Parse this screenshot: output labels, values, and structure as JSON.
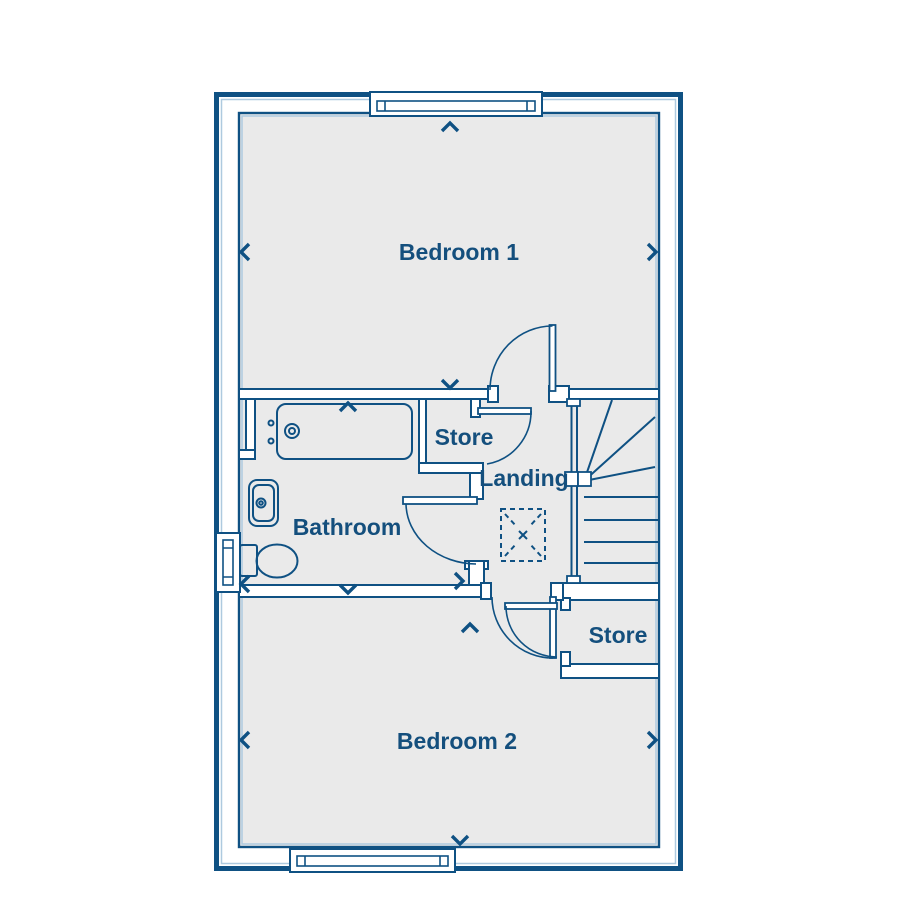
{
  "plan": {
    "type": "floor-plan",
    "floor": "first-floor",
    "rooms": [
      {
        "id": "bedroom1",
        "label": "Bedroom 1"
      },
      {
        "id": "store_upper",
        "label": "Store"
      },
      {
        "id": "landing",
        "label": "Landing"
      },
      {
        "id": "bathroom",
        "label": "Bathroom"
      },
      {
        "id": "store_lower",
        "label": "Store"
      },
      {
        "id": "bedroom2",
        "label": "Bedroom 2"
      }
    ],
    "fixtures": [
      "bathtub",
      "basin",
      "toilet",
      "staircase",
      "loft-hatch"
    ],
    "window_count": 3,
    "door_count": 5,
    "colors": {
      "wall": "#0f5183",
      "wall_highlight": "#aecadf",
      "floor": "#eaeaea",
      "label": "#144f7d",
      "background": "#ffffff"
    }
  }
}
